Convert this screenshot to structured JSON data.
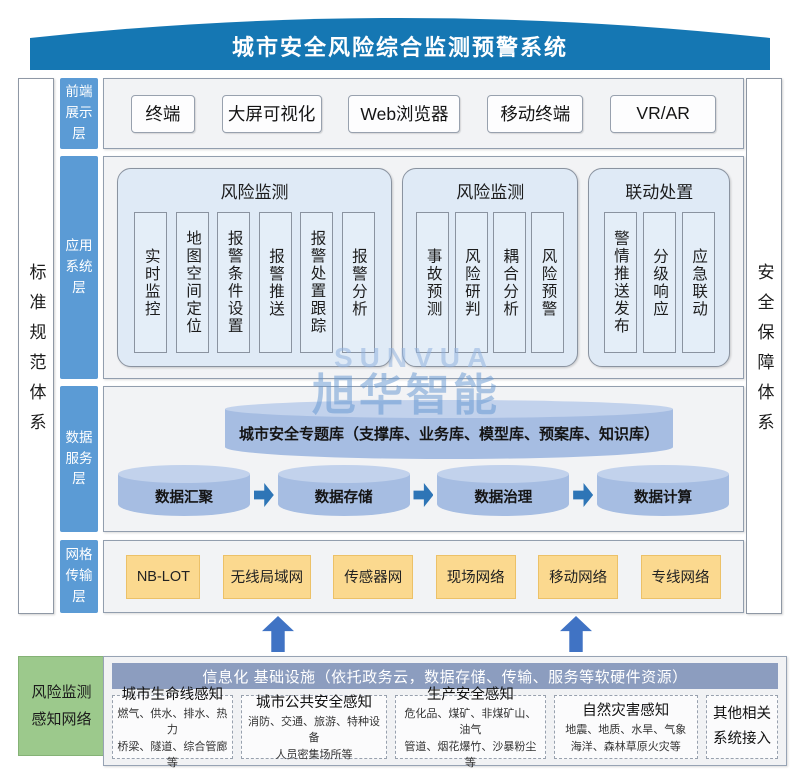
{
  "banner": {
    "title": "城市安全风险综合监测预警系统"
  },
  "side_bars": {
    "left": "标准规范体系",
    "right": "安全保障体系"
  },
  "watermark": {
    "line1": "SUNVUA",
    "line2": "旭华智能"
  },
  "layers": {
    "frontend": {
      "label": "前端展示层",
      "items": [
        "终端",
        "大屏可视化",
        "Web浏览器",
        "移动终端",
        "VR/AR"
      ]
    },
    "application": {
      "label": "应用系统层",
      "groups": [
        {
          "title": "风险监测",
          "items": [
            "实时监控",
            "地图空间定位",
            "报警条件设置",
            "报警推送",
            "报警处置跟踪",
            "报警分析"
          ]
        },
        {
          "title": "风险监测",
          "items": [
            "事故预测",
            "风险研判",
            "耦合分析",
            "风险预警"
          ]
        },
        {
          "title": "联动处置",
          "items": [
            "警情推送发布",
            "分级响应",
            "应急联动"
          ]
        }
      ]
    },
    "data_service": {
      "label": "数据服务层",
      "theme_db": "城市安全专题库（支撑库、业务库、模型库、预案库、知识库）",
      "pipeline": [
        "数据汇聚",
        "数据存储",
        "数据治理",
        "数据计算"
      ]
    },
    "transport": {
      "label": "网格传输层",
      "items": [
        "NB-LOT",
        "无线局域网",
        "传感器网",
        "现场网络",
        "移动网络",
        "专线网络"
      ]
    }
  },
  "perception": {
    "side_label": "风险监测感知网络",
    "header": "信息化 基础设施（依托政务云，数据存储、传输、服务等软硬件资源）",
    "boxes": [
      {
        "title": "城市生命线感知",
        "line1": "燃气、供水、排水、热力",
        "line2": "桥梁、隧道、综合管廊等"
      },
      {
        "title": "城市公共安全感知",
        "line1": "消防、交通、旅游、特种设备",
        "line2": "人员密集场所等"
      },
      {
        "title": "生产安全感知",
        "line1": "危化品、煤矿、非煤矿山、油气",
        "line2": "管道、烟花爆竹、沙暴粉尘等"
      },
      {
        "title": "自然灾害感知",
        "line1": "地震、地质、水旱、气象",
        "line2": "海洋、森林草原火灾等"
      },
      {
        "title": "其他相关系统接入"
      }
    ]
  },
  "colors": {
    "banner_blue": "#1577b3",
    "layer_label_blue": "#5b9bd5",
    "group_fill_blue": "#dfeaf6",
    "cylinder_blue": "#a6bde2",
    "flow_arrow_blue": "#2e75b6",
    "up_arrow_blue": "#4073c4",
    "transport_orange": "#fbd98f",
    "perception_green": "#9cc98c",
    "infra_header_gray_blue": "#8c9dbf",
    "row_fill": "#f2f3f5"
  }
}
